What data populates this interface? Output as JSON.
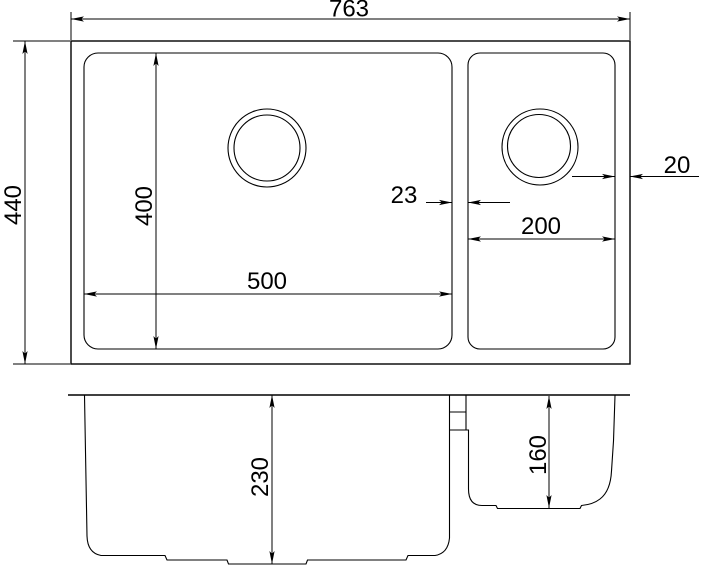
{
  "diagram": {
    "type": "technical-drawing",
    "subject": "Undermount double-bowl kitchen sink, dimensioned drawing",
    "views": [
      {
        "id": "top-view",
        "name": "plan view with bowls and drain openings"
      },
      {
        "id": "front-view",
        "name": "front section view showing bowl depths"
      }
    ],
    "background": "#ffffff",
    "line_color": "#000000"
  },
  "dimensions": {
    "overall_width": {
      "label": "763",
      "value": 763,
      "view": "top",
      "measures": "overall sink width"
    },
    "overall_depth": {
      "label": "440",
      "value": 440,
      "view": "top",
      "measures": "overall front-to-back depth"
    },
    "main_bowl_front_to_back": {
      "label": "400",
      "value": 400,
      "view": "top",
      "measures": "main bowl front-to-back size"
    },
    "main_bowl_width": {
      "label": "500",
      "value": 500,
      "view": "top",
      "measures": "main bowl width"
    },
    "divider_width": {
      "label": "23",
      "value": 23,
      "view": "top",
      "measures": "divider between bowls"
    },
    "small_bowl_width": {
      "label": "200",
      "value": 200,
      "view": "top",
      "measures": "small bowl width"
    },
    "right_rim_width": {
      "label": "20",
      "value": 20,
      "view": "top",
      "measures": "right rim width beside small bowl"
    },
    "main_bowl_depth": {
      "label": "230",
      "value": 230,
      "view": "front",
      "measures": "main bowl depth"
    },
    "small_bowl_depth": {
      "label": "160",
      "value": 160,
      "view": "front",
      "measures": "small bowl depth"
    }
  }
}
